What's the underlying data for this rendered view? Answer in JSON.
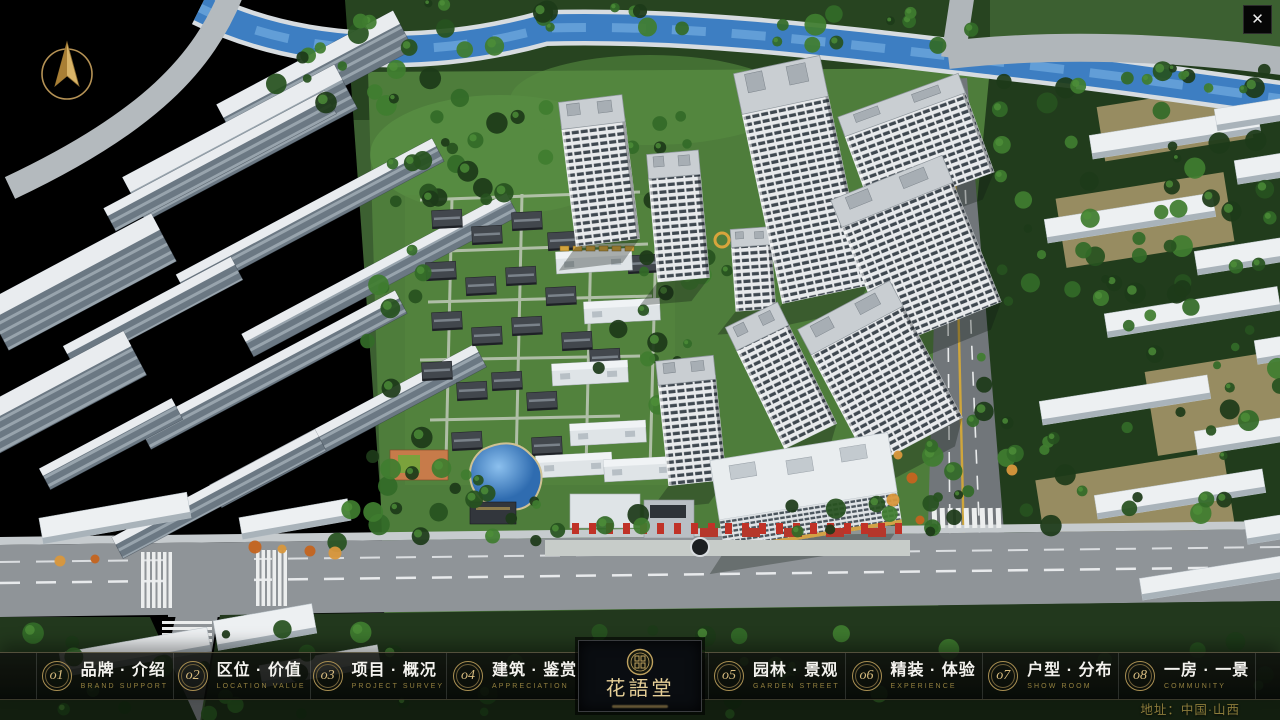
{
  "window": {
    "close_glyph": "✕"
  },
  "nav": {
    "items": [
      {
        "num": "o1",
        "zh": "品牌 · 介绍",
        "en": "BRAND SUPPORT"
      },
      {
        "num": "o2",
        "zh": "区位 · 价值",
        "en": "LOCATION VALUE"
      },
      {
        "num": "o3",
        "zh": "项目 · 概况",
        "en": "PROJECT SURVEY"
      },
      {
        "num": "o4",
        "zh": "建筑 · 鉴赏",
        "en": "APPRECIATION"
      },
      {
        "num": "o5",
        "zh": "园林 · 景观",
        "en": "GARDEN STREET"
      },
      {
        "num": "o6",
        "zh": "精装 · 体验",
        "en": "EXPERIENCE"
      },
      {
        "num": "o7",
        "zh": "户型 · 分布",
        "en": "SHOW ROOM"
      },
      {
        "num": "o8",
        "zh": "一房 · 一景",
        "en": "COMMUNITY"
      }
    ],
    "logo": {
      "title": "花語堂"
    }
  },
  "footer": {
    "address": "地址：中国·山西"
  },
  "icons": {
    "close": "close-icon",
    "compass": "north-compass-icon",
    "seal": "brand-seal-icon"
  },
  "colors": {
    "gold": "#c9a25e",
    "gold_text": "#d9bd80",
    "nav_chinese": "#f4f3ef",
    "nav_english": "#93803f",
    "bar_background": "rgba(10,12,10,0.88)",
    "river": "#3d7ec2",
    "grass": "#4e7d3b",
    "road": "#8f9498",
    "address_text": "#8c7c3b"
  }
}
